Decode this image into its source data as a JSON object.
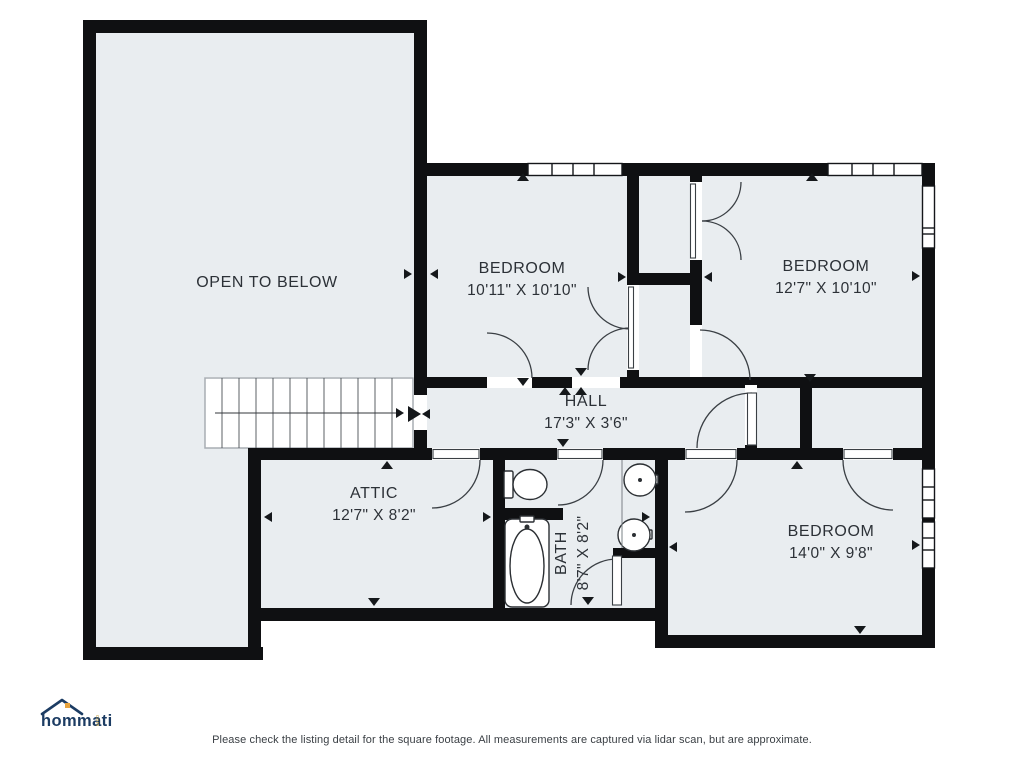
{
  "plan": {
    "rooms": {
      "open_to_below": {
        "name": "OPEN TO BELOW"
      },
      "bedroom_top_left": {
        "name": "BEDROOM",
        "dims": "10'11\" X 10'10\""
      },
      "bedroom_top_right": {
        "name": "BEDROOM",
        "dims": "12'7\" X 10'10\""
      },
      "hall": {
        "name": "HALL",
        "dims": "17'3\" X 3'6\""
      },
      "attic": {
        "name": "ATTIC",
        "dims": "12'7\" X 8'2\""
      },
      "bath": {
        "name": "BATH",
        "dims": "8'7\" X 8'2\""
      },
      "bedroom_bottom_right": {
        "name": "BEDROOM",
        "dims": "14'0\" X 9'8\""
      }
    },
    "features": [
      "stairs-with-direction-arrow",
      "windows",
      "door-swings",
      "toilet",
      "bathtub",
      "double-vanity-sinks"
    ]
  },
  "branding": {
    "logo_text": "hommati",
    "logo_suffix": "com"
  },
  "footer": {
    "disclaimer": "Please check the listing detail for the square footage. All measurements are captured via lidar scan, but are approximate."
  },
  "colors": {
    "wall": "#0f1012",
    "floor": "#e9edf0",
    "line": "#3a3f44",
    "text": "#2c3137",
    "logo_navy": "#1c3c63",
    "logo_orange": "#e8a33d"
  }
}
